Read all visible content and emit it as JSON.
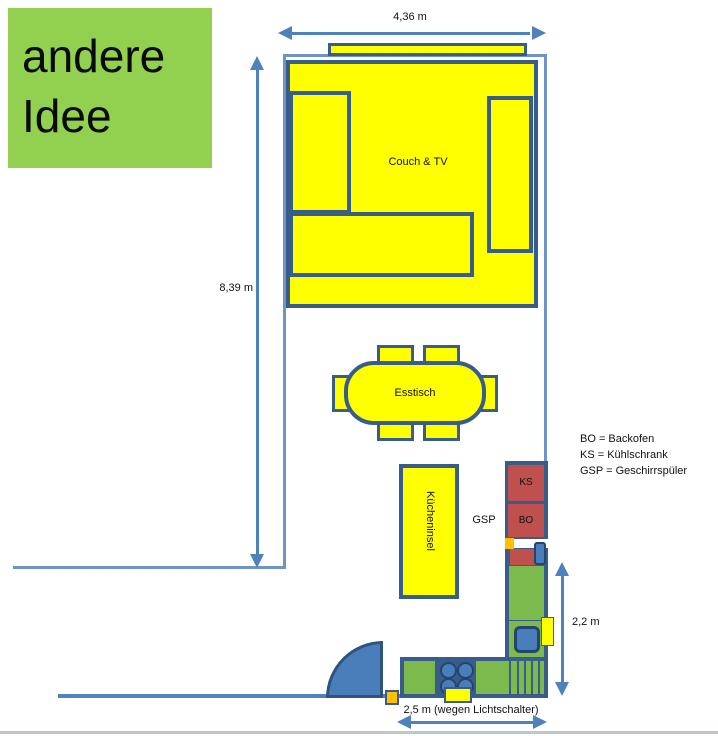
{
  "title_box": {
    "text": "andere Idee",
    "bg": "#92D050"
  },
  "dimensions": {
    "top": "4,36 m",
    "left": "8,39 m",
    "right": "2,2 m",
    "bottom": "2,5 m (wegen Lichtschalter)"
  },
  "labels": {
    "couch": "Couch & TV",
    "esstisch": "Esstisch",
    "kuecheninsel": "Kücheninsel",
    "gsp": "GSP",
    "ks": "KS",
    "bo": "BO"
  },
  "legend": {
    "lines": [
      "BO = Backofen",
      "KS = Kühlschrank",
      "GSP = Geschirrspüler"
    ]
  },
  "colors": {
    "yellow": "#FFFF00",
    "green_title": "#92D050",
    "green_counter": "#7CBA4D",
    "blue_medium": "#4A7EBB",
    "blue_dark_border": "#385D8A",
    "blue_wall_light": "#6F94C4",
    "red_appliance": "#C0504D",
    "orange": "#FFC000",
    "arrow_blue": "#4F81BD"
  }
}
